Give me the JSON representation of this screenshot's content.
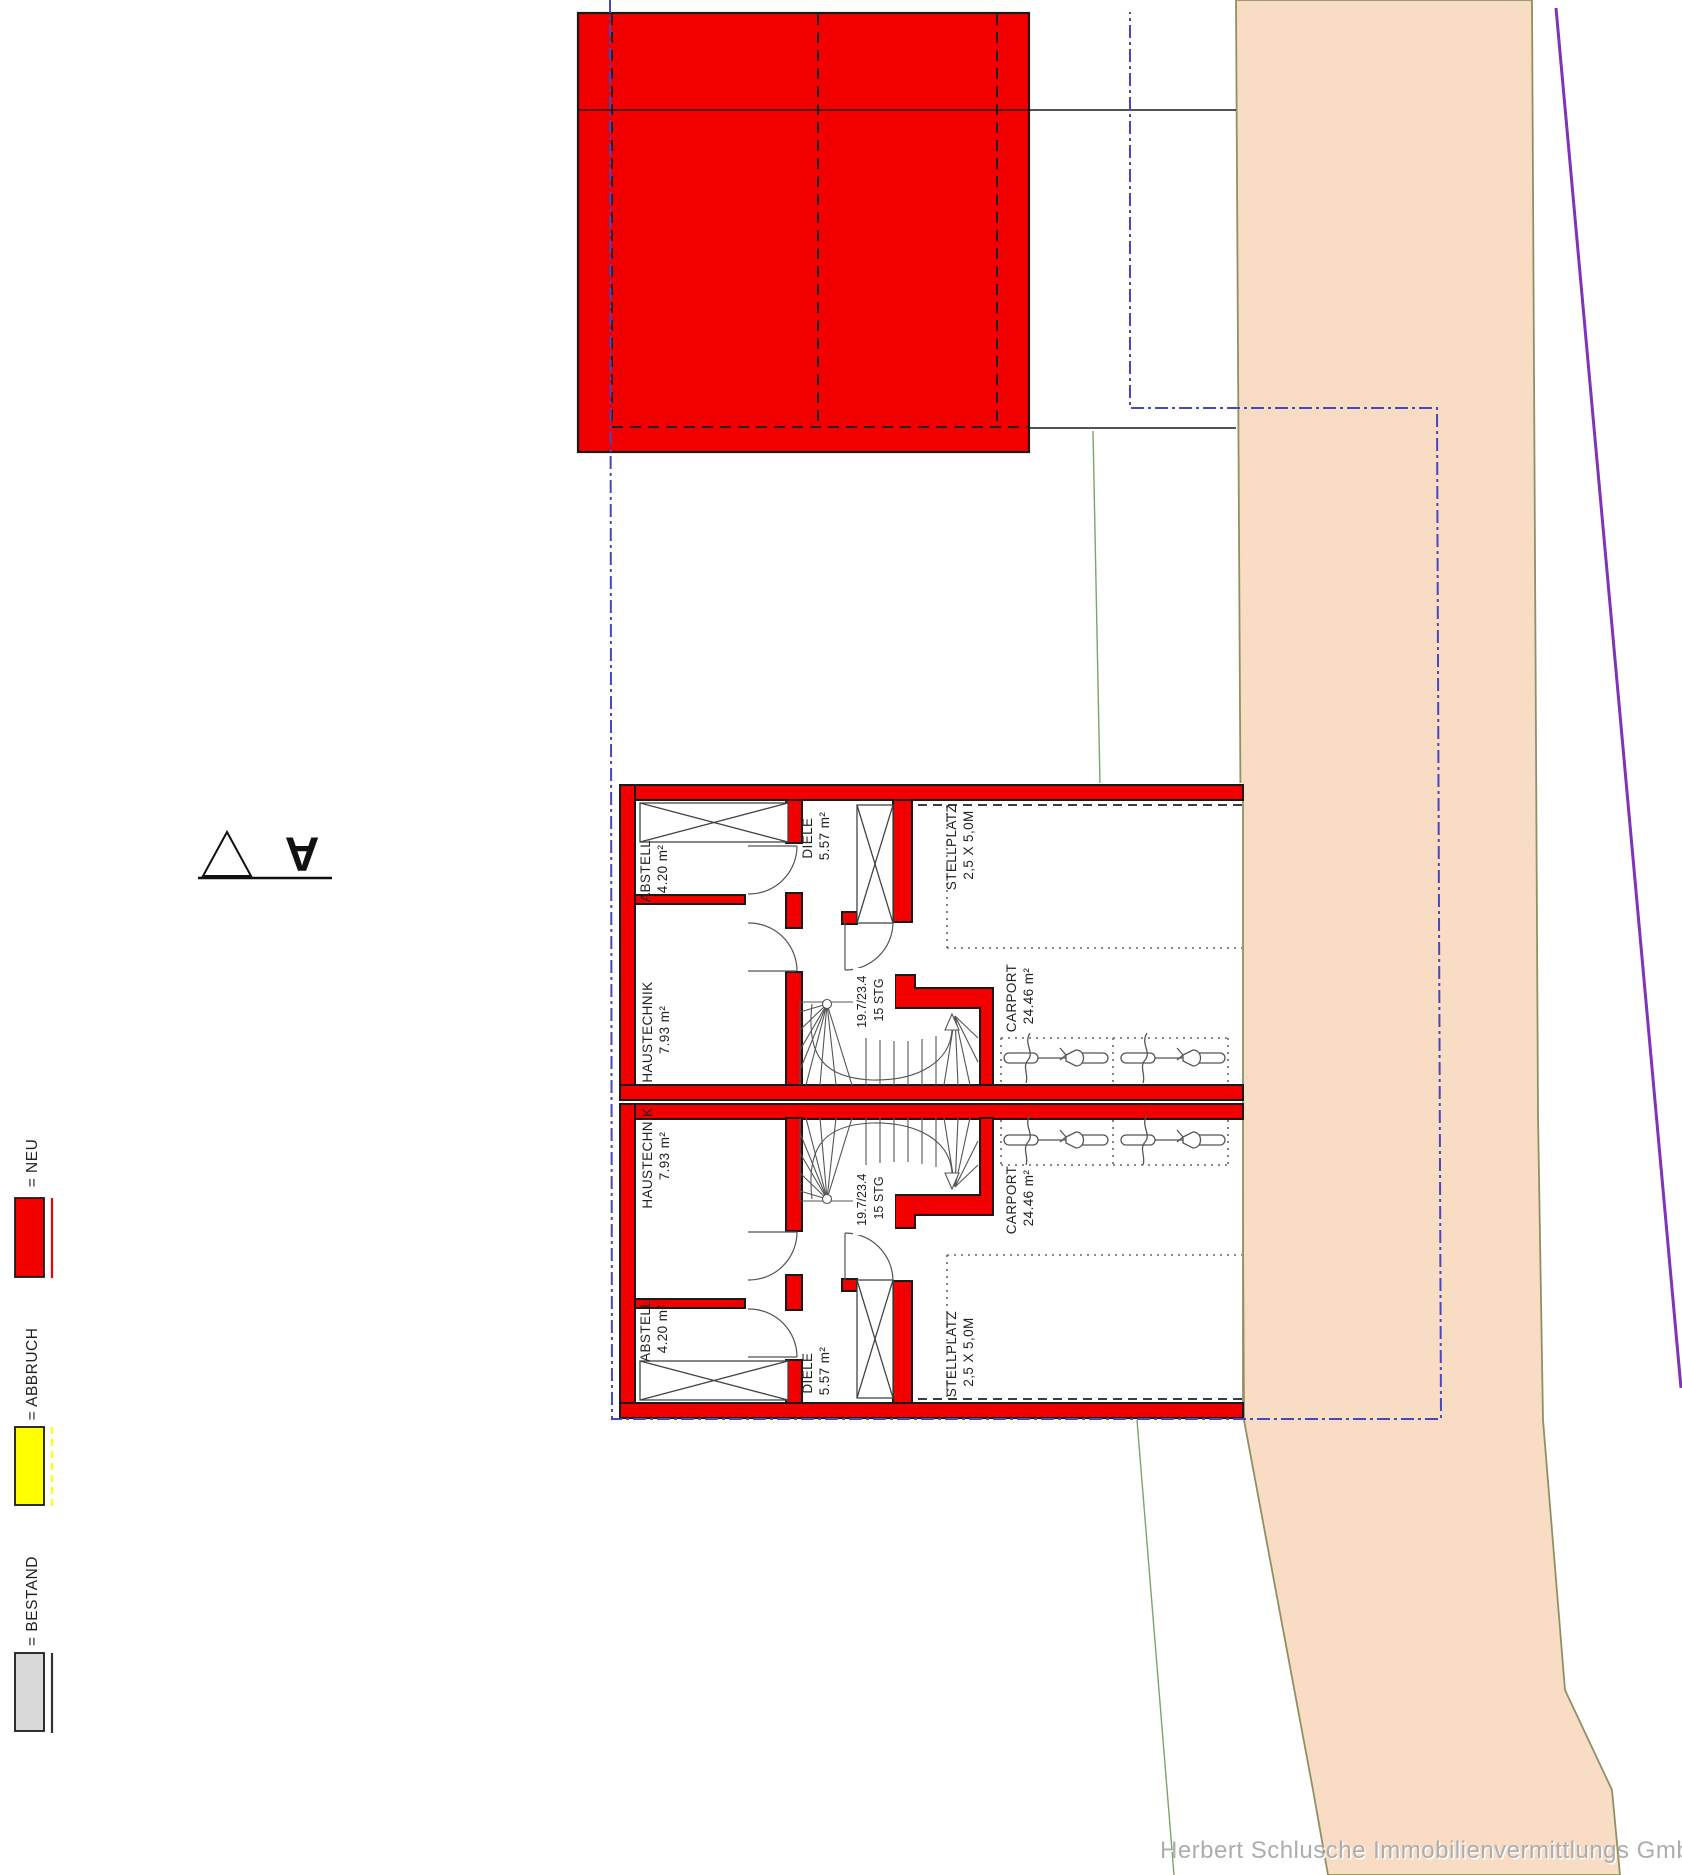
{
  "legend": {
    "items": [
      {
        "label": "= NEU",
        "color": "#f20000"
      },
      {
        "label": "= ABBRUCH",
        "color": "#ffff00"
      },
      {
        "label": "= BESTAND",
        "color": "#d9d9d9"
      }
    ]
  },
  "section_marker": {
    "label": "A"
  },
  "plan": {
    "units": [
      {
        "rooms": [
          {
            "name": "ABSTELL",
            "area": "4.20 m²"
          },
          {
            "name": "DIELE",
            "area": "5.57 m²"
          },
          {
            "name": "HAUSTECHNIK",
            "area": "7.93 m²"
          },
          {
            "name": "STELLPLATZ",
            "area": "2,5 X 5,0M"
          },
          {
            "name": "CARPORT",
            "area": "24.46 m²"
          }
        ],
        "stairs": {
          "dimensions": "19.7/23.4",
          "steps": "15 STG"
        }
      },
      {
        "rooms": [
          {
            "name": "ABSTELL",
            "area": "4.20 m²"
          },
          {
            "name": "DIELE",
            "area": "5.57 m²"
          },
          {
            "name": "HAUSTECHNIK",
            "area": "7.93 m²"
          },
          {
            "name": "STELLPLATZ",
            "area": "2,5 X 5,0M"
          },
          {
            "name": "CARPORT",
            "area": "24.46 m²"
          }
        ],
        "stairs": {
          "dimensions": "19.7/23.4",
          "steps": "15 STG"
        }
      }
    ]
  },
  "watermark": "Herbert Schlusche Immobilienvermittlungs GmbH",
  "colors": {
    "neu_red": "#f20000",
    "abbruch_yellow": "#ffff00",
    "bestand_gray": "#d9d9d9",
    "site_peach": "#f9dcc4",
    "peach_edge_olive": "#8f9064",
    "boundary_blue": "#4747c2",
    "boundary_purple": "#8032b8",
    "terrain_green": "#7fa36b"
  }
}
